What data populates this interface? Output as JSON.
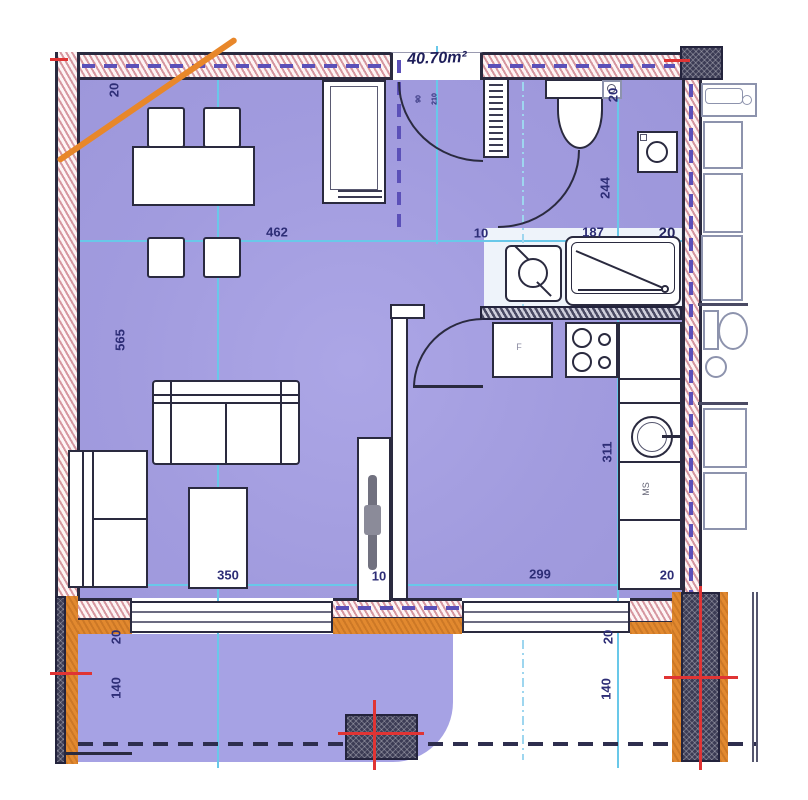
{
  "plan": {
    "area_label": "40.70m²",
    "door_labels": {
      "w": "90",
      "h": "210"
    },
    "labels": {
      "ms": "MS",
      "fridge": "F"
    },
    "dims": {
      "wall_top_left": "20",
      "living_width": "462",
      "hall_width": "10",
      "bath_width": "187",
      "wall_top_right": "20",
      "wc_side": "20",
      "living_height": "565",
      "bath_depth": "244",
      "kitchen_depth": "311",
      "living_bottom": "350",
      "partition": "10",
      "kitchen_bottom": "299",
      "wall_bottom_right": "20",
      "balcony_l_wall": "20",
      "balcony_l_depth": "140",
      "balcony_r_wall": "20",
      "balcony_r_depth": "140"
    },
    "colors": {
      "room_fill": "#a19bde",
      "balcony_fill": "#a6a2e4",
      "wall_hatch_pink": "#d697a0",
      "dim_line_cyan": "#69c8e9",
      "dim_text_navy": "#2d2d76",
      "axis_dash_purple": "#5b50b8",
      "accent_orange": "#e2892f",
      "mark_red": "#e03434",
      "line_dark": "#2a2a3f"
    }
  }
}
